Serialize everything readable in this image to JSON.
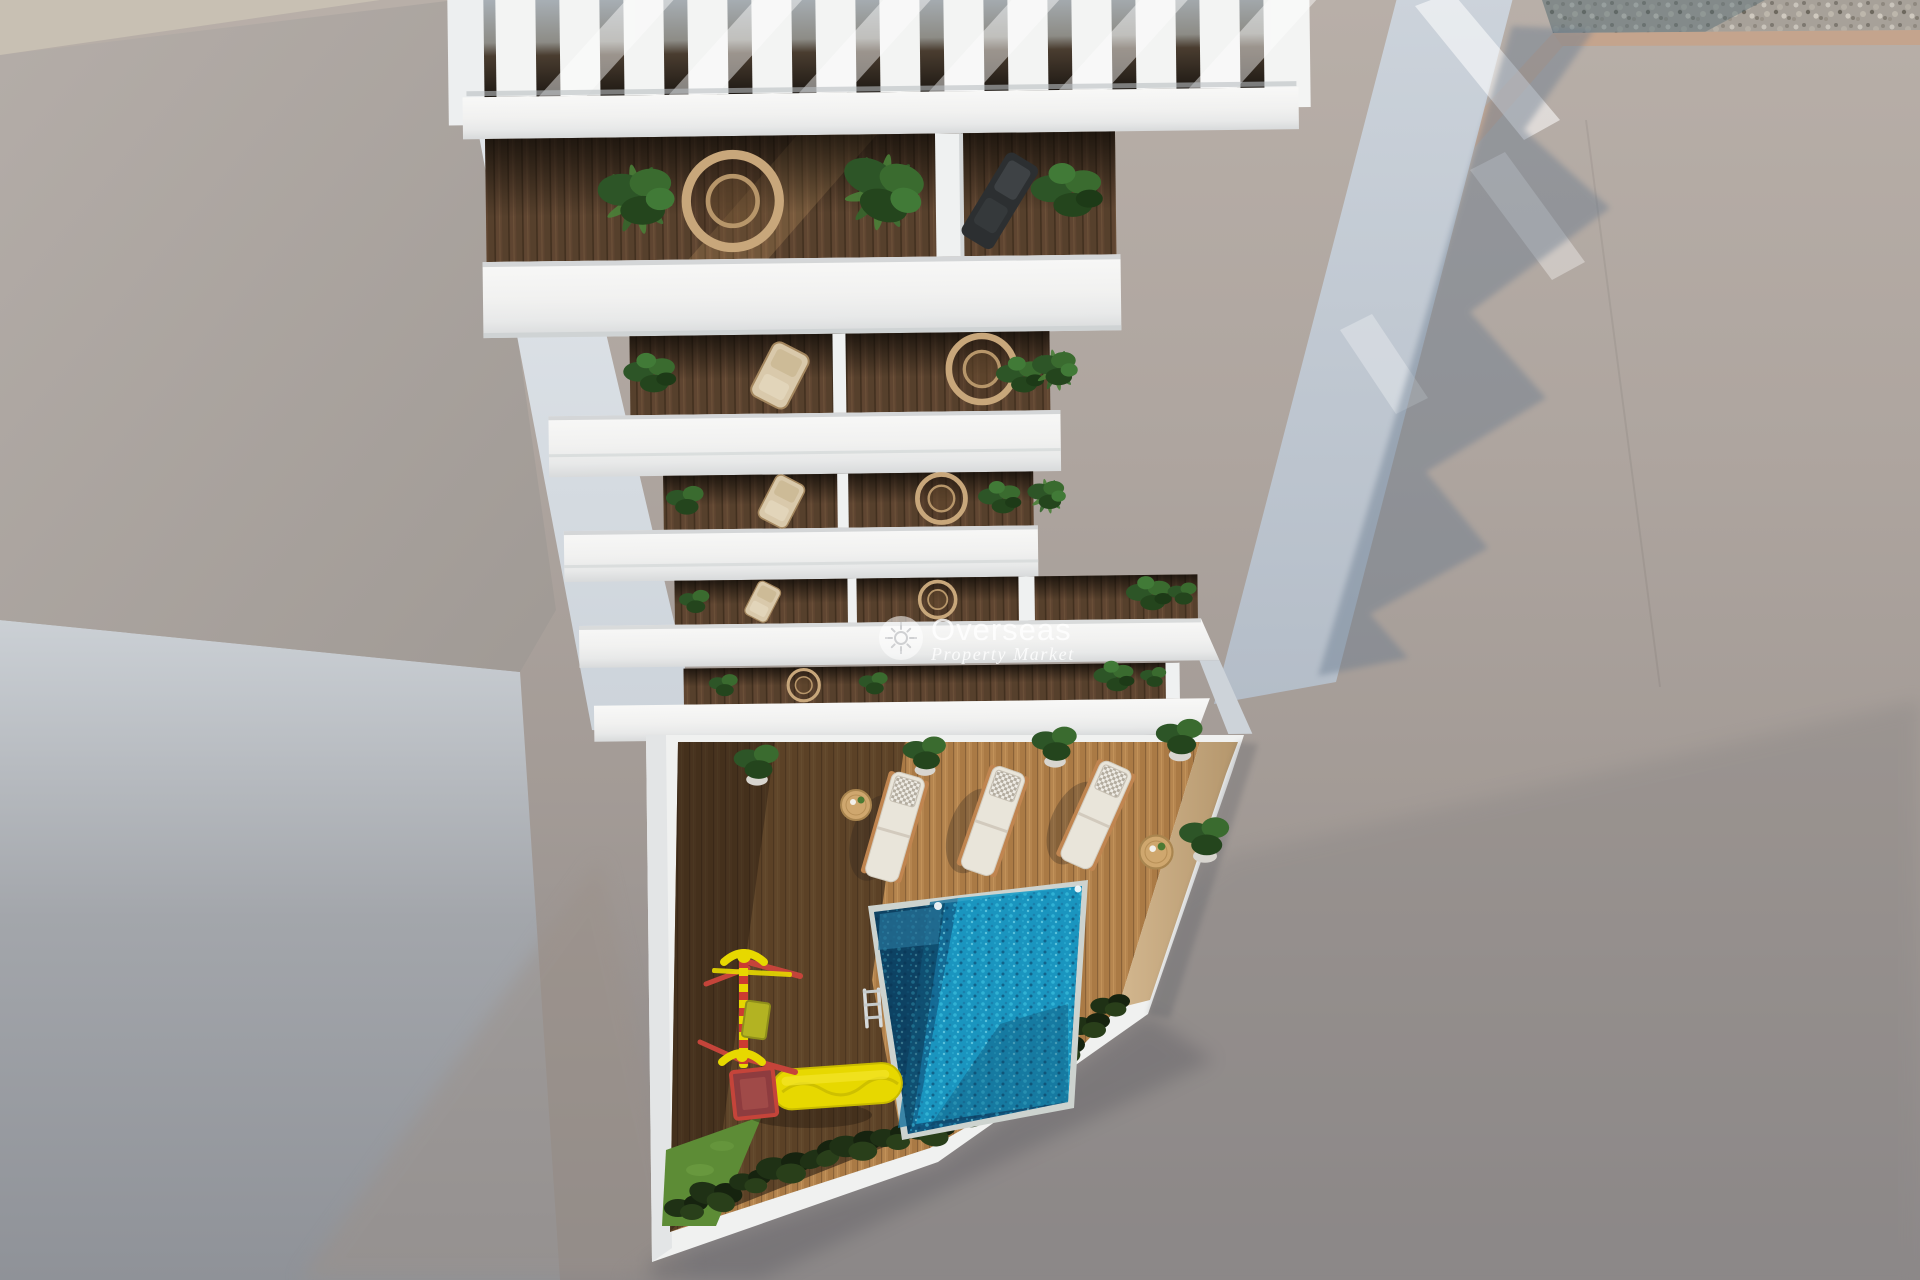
{
  "scene": {
    "title": "Aerial 3D render of apartment building with pool courtyard",
    "description": "Top-down aerial architectural render: a white multi-storey apartment building with a slatted roof pergola and five stacked balcony levels furnished with plants, wicker chairs and loungers, above a private courtyard containing a wooden deck, three white sun loungers, side tables, potted plants, a turquoise swimming pool with ladder, a children's playground with yellow slide, hedges and grass. Concrete roofs on the left, sunlit pavement with a gravel strip on the right, and long zig-zag building shadows.",
    "colors": {
      "building_white": "#f3f4f3",
      "beige_strip": "#c8c0b3",
      "roof_gray": "#aaa39e",
      "ground_light": "#b6ada6",
      "ground_dark": "#8d8989",
      "gravel_base": "#a29c93",
      "tan_strip": "#c4a48d",
      "shadow_blue": "#66788c",
      "wall_light": "#dde2e7",
      "wood_sun": "#b5854f",
      "wood_shade": "#5f4531",
      "tan_wall": "#c7ab83",
      "pool_deep": "#11567e",
      "pool_bright": "#1c9cc6",
      "grass_green": "#5d8c36",
      "bush_green": "#1f3115",
      "plant_green": "#3a6b2f",
      "wicker_tan": "#c8a77b",
      "lounger_white": "#e9e5da",
      "slide_yellow": "#e7d800",
      "play_red": "#c5443a",
      "watermark_white": "rgba(255,255,255,0.82)"
    }
  },
  "watermark": {
    "brand": "Overseas",
    "tagline": "Property Market",
    "icon": "sun-icon"
  }
}
